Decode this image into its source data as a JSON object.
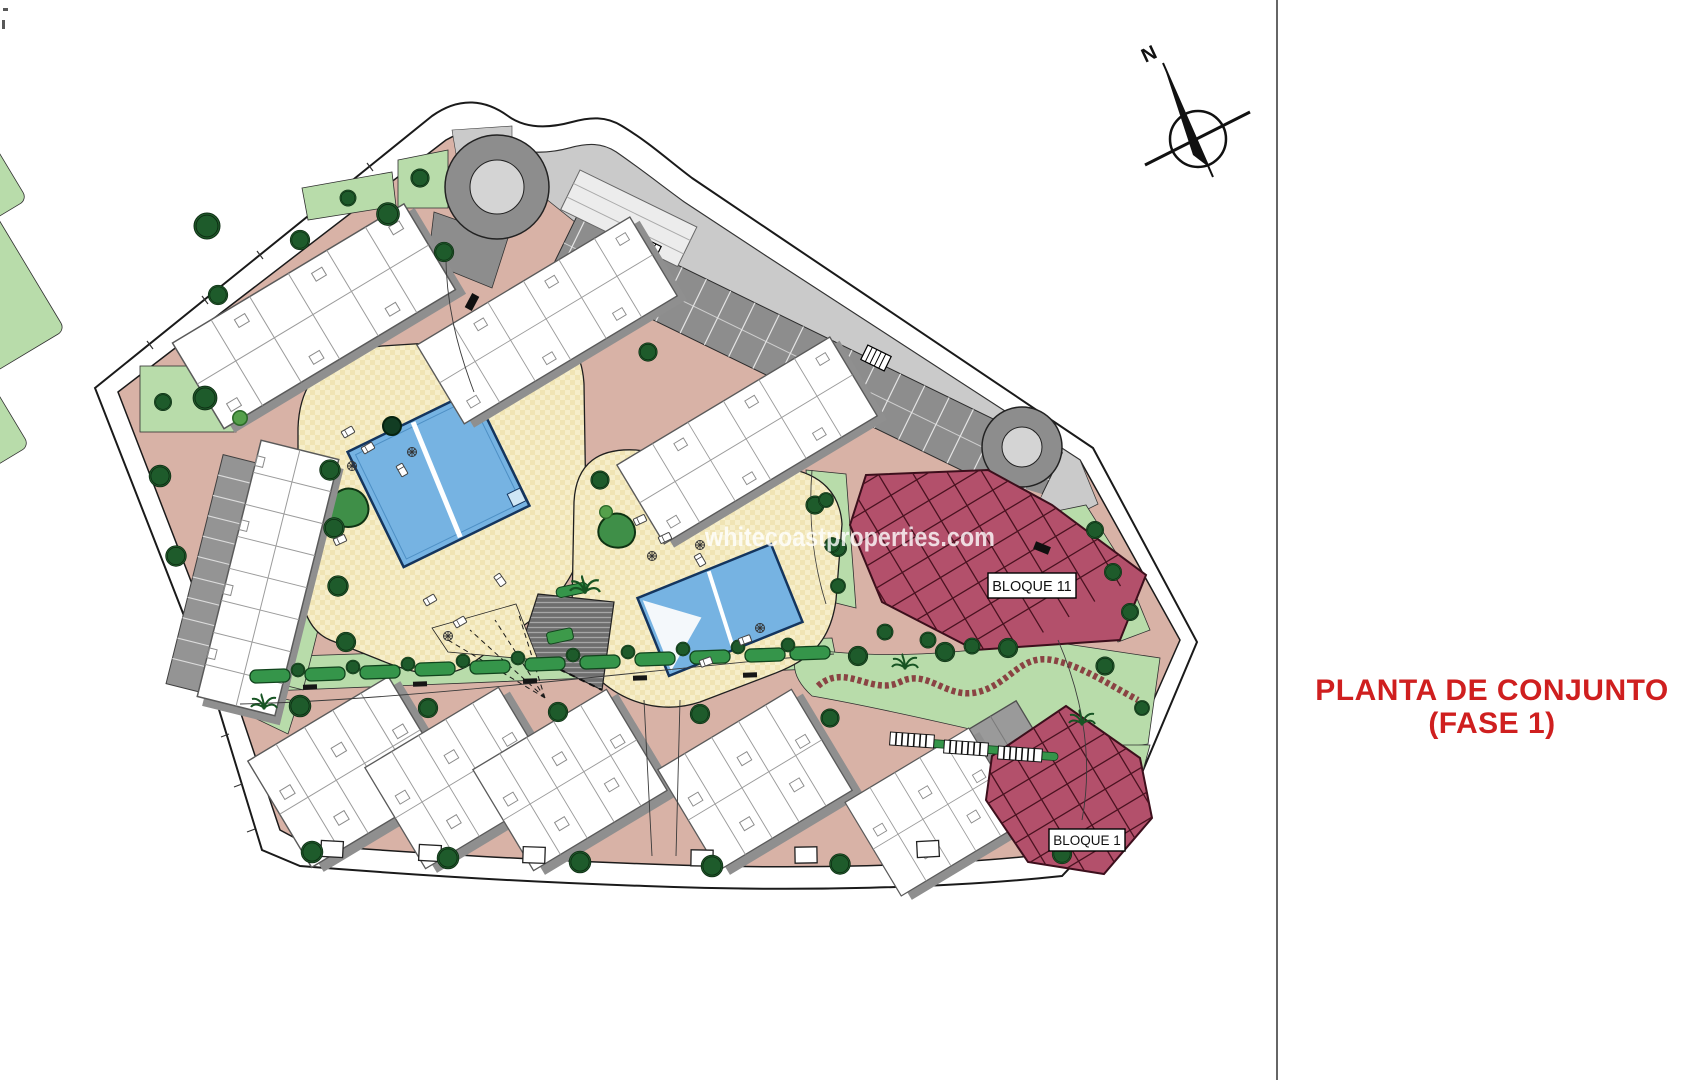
{
  "title": {
    "line1": "PLANTA DE CONJUNTO",
    "line2": "(FASE 1)",
    "color": "#cf1f1f"
  },
  "watermark": {
    "text": "whitecoastproperties.com"
  },
  "compass": {
    "north_label": "N"
  },
  "plan": {
    "labels": {
      "bloque11": "BLOQUE 11",
      "bloque1": "BLOQUE 1"
    },
    "legend_colors": {
      "road": "#d8b2a6",
      "lawn": "#b8dcaa",
      "hedge": "#35954a",
      "tree": "#1e5b2b",
      "amenity_deck": "#f6eeca",
      "pool": "#76b3e2",
      "parking_dark": "#8d8d8d",
      "parking_light": "#cacaca",
      "building": "#ffffff",
      "building_shadow": "#8f8f8f",
      "phase_block": "#b3506b",
      "boundary": "#1a1a1a"
    }
  }
}
